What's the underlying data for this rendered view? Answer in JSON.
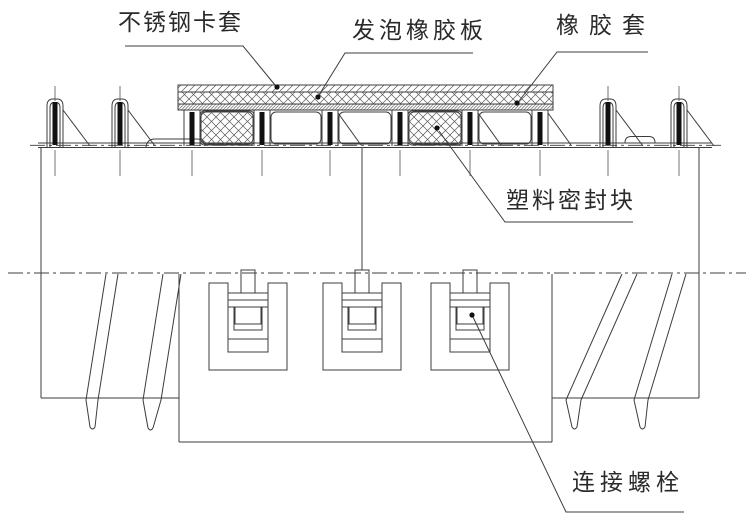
{
  "diagram": {
    "type": "technical-drawing",
    "annotations": [
      {
        "id": "stainless-steel-clamp-sleeve",
        "text": "不锈钢卡套"
      },
      {
        "id": "foamed-rubber-plate",
        "text": "发泡橡胶板"
      },
      {
        "id": "rubber-sleeve",
        "text": "橡胶套"
      },
      {
        "id": "plastic-sealing-block",
        "text": "塑料密封块"
      },
      {
        "id": "connecting-bolt",
        "text": "连接螺栓"
      }
    ],
    "colors": {
      "line": "#3c3c3c",
      "bolt": "#111111",
      "background": "#ffffff",
      "text": "#2a2a2a"
    }
  }
}
